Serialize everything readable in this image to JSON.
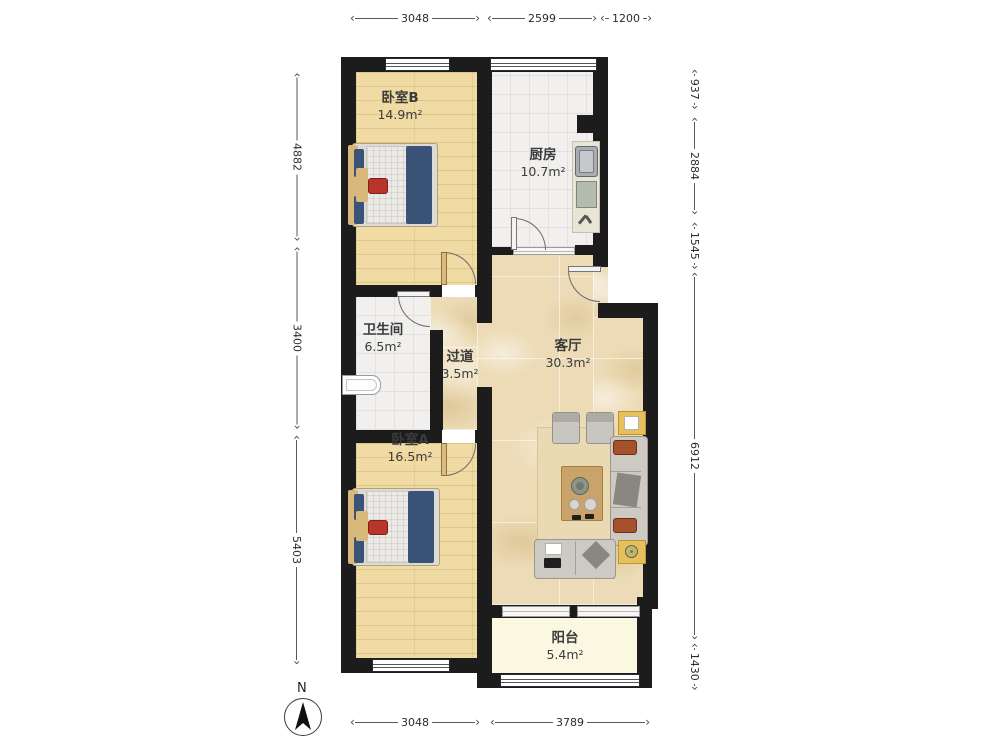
{
  "title": "apartment-floor-plan",
  "rooms": {
    "bedroomB": {
      "name": "卧室B",
      "area": "14.9m²"
    },
    "kitchen": {
      "name": "厨房",
      "area": "10.7m²"
    },
    "bathroom": {
      "name": "卫生间",
      "area": "6.5m²"
    },
    "hallway": {
      "name": "过道",
      "area": "3.5m²"
    },
    "living": {
      "name": "客厅",
      "area": "30.3m²"
    },
    "bedroomA": {
      "name": "卧室A",
      "area": "16.5m²"
    },
    "balcony": {
      "name": "阳台",
      "area": "5.4m²"
    }
  },
  "dimensions": {
    "top": [
      "3048",
      "2599",
      "1200"
    ],
    "bottom": [
      "3048",
      "3789"
    ],
    "left": [
      "4882",
      "3400",
      "5403"
    ],
    "right": [
      "937",
      "2884",
      "1545",
      "6912",
      "1430"
    ]
  },
  "compass": {
    "label": "N"
  },
  "colors": {
    "wall": "#1c1c1c",
    "wood_floor": "#f1dba4",
    "tile_floor": "#f1f0ee",
    "marble_floor": "#ecdbb6",
    "balcony_floor": "#fbf8e2",
    "bed_blanket": "#3b5377",
    "accent_red": "#b8352c",
    "sofa_gray": "#cdc9c3",
    "table_gold": "#e6bf5e"
  }
}
